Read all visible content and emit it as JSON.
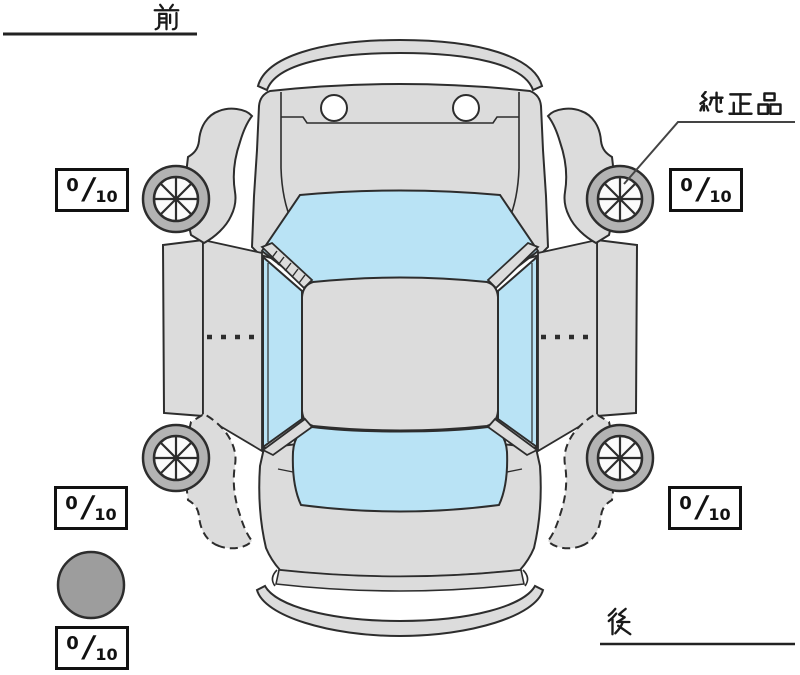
{
  "labels": {
    "front": "前",
    "rear": "後",
    "genuine_part": "純正品"
  },
  "slash": "/",
  "tread": {
    "front_left": {
      "num": "0",
      "den": "10"
    },
    "front_right": {
      "num": "0",
      "den": "10"
    },
    "rear_left": {
      "num": "0",
      "den": "10"
    },
    "rear_right": {
      "num": "0",
      "den": "10"
    },
    "spare": {
      "num": "0",
      "den": "10"
    }
  },
  "icons": {
    "car": "car-top-view",
    "wheel": "wheel-8-spoke-icon",
    "spare": "spare-tire-circle",
    "callout": "genuine-part-leader-line"
  },
  "colors": {
    "background": "#ffffff",
    "body_gray": "#dcdcdc",
    "glass_blue": "#b9e3f5",
    "wheel_ring": "#b3b3b3",
    "wheel_hub": "#fbfbfb",
    "spare_gray": "#9d9d9d",
    "line": "#2d2d2d",
    "text": "#111111"
  }
}
